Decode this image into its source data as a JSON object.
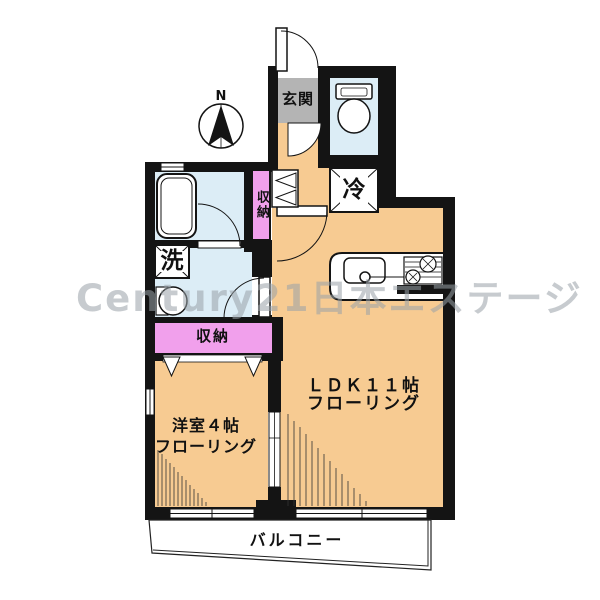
{
  "title": "apartment-floorplan",
  "compass": {
    "label": "N"
  },
  "watermark": {
    "text": "Century21日本エステージ"
  },
  "labels": {
    "genkan": "玄関",
    "closet_upper": "収納",
    "fridge": "冷",
    "washer": "洗",
    "closet_lower": "収納",
    "ldk_line1": "ＬＤＫ１１帖",
    "ldk_line2": "フローリング",
    "western_line1": "洋室４帖",
    "western_line2": "フローリング",
    "balcony": "バルコニー"
  },
  "colors": {
    "floor_orange": "#F7CB92",
    "water_blue": "#DCEDF6",
    "closet_pink": "#F1A0EC",
    "genkan_gray": "#B4B4B4",
    "wall_black": "#141414",
    "watermark_gray": "#9AA2A8"
  }
}
